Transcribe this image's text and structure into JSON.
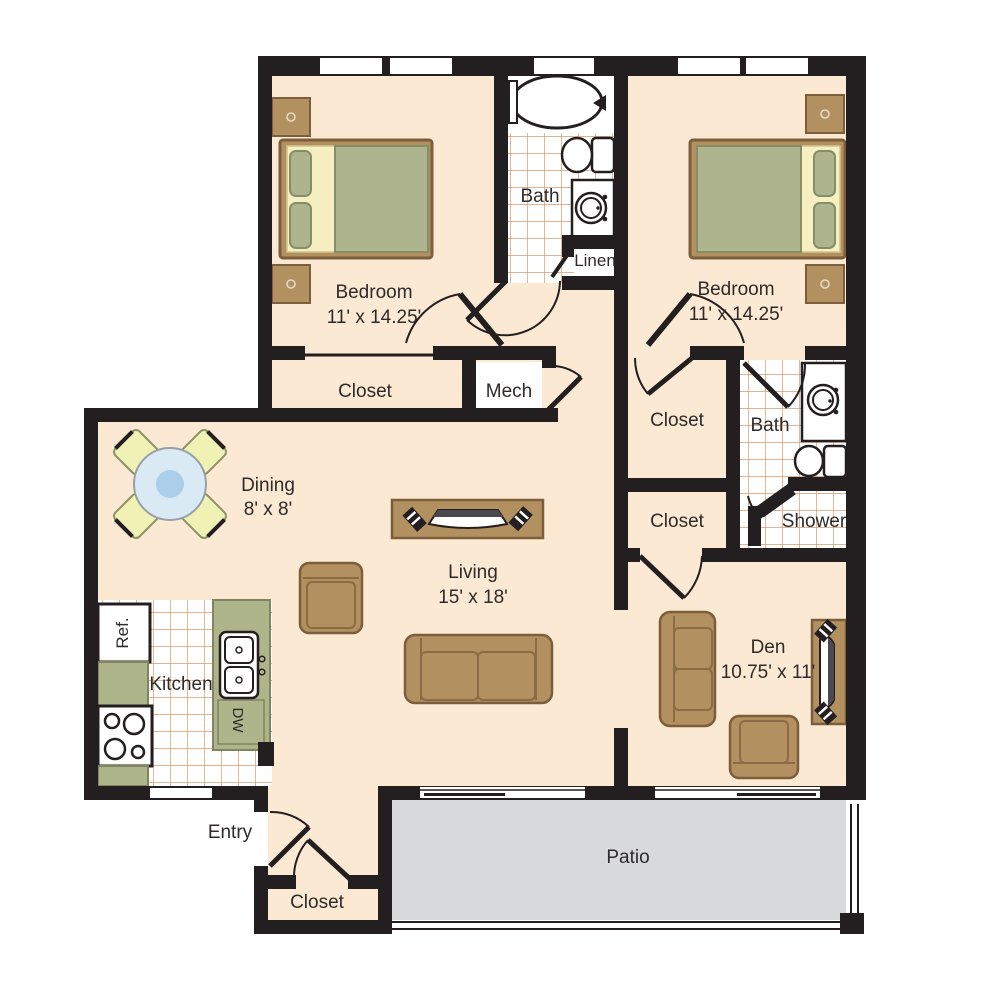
{
  "plan_title": "Two bedroom apartment floor plan",
  "labels": {
    "bedroom_left": {
      "name": "Bedroom",
      "dims": "11' x 14.25'"
    },
    "bedroom_right": {
      "name": "Bedroom",
      "dims": "11' x 14.25'"
    },
    "bath_top": {
      "name": "Bath"
    },
    "linen": {
      "name": "Linen"
    },
    "closet_bedroom_left": {
      "name": "Closet"
    },
    "mech": {
      "name": "Mech"
    },
    "dining": {
      "name": "Dining",
      "dims": "8' x 8'"
    },
    "living": {
      "name": "Living",
      "dims": "15' x 18'"
    },
    "closet_hall_upper": {
      "name": "Closet"
    },
    "closet_hall_lower": {
      "name": "Closet"
    },
    "bath_right": {
      "name": "Bath"
    },
    "shower": {
      "name": "Shower"
    },
    "den": {
      "name": "Den",
      "dims": "10.75' x 11'"
    },
    "kitchen": {
      "name": "Kitchen"
    },
    "refrigerator": {
      "name": "Ref."
    },
    "dishwasher": {
      "name": "DW"
    },
    "entry": {
      "name": "Entry"
    },
    "closet_entry": {
      "name": "Closet"
    },
    "patio": {
      "name": "Patio"
    }
  },
  "colors": {
    "wall": "#231f20",
    "floor": "#fbe9d3",
    "patio": "#d8d9db",
    "tile_line": "#d59b6c",
    "counter": "#aeb58b",
    "counter_outline": "#7e8560",
    "furniture": "#b3905f",
    "furniture_outline": "#7d5e3c",
    "mattress": "#aeb48e",
    "mattress_outline": "#868e66",
    "sheet": "#f5efc2",
    "chair": "#eff2b4",
    "chair_outline": "#8c9168",
    "table_ring": "#d9eaf5",
    "table_center": "#abcfe9",
    "text": "#2e2a29"
  }
}
